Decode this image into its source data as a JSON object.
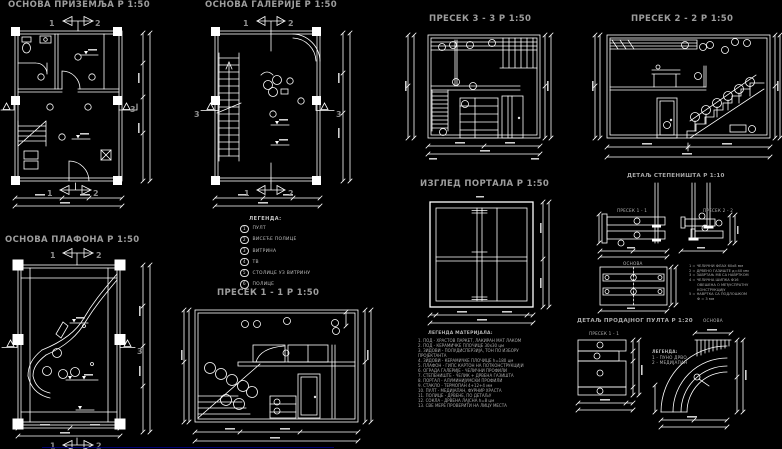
{
  "palette": {
    "background": "#000000",
    "lines": "#ffffff",
    "titles": "#9d9d9d",
    "markers": "#8f8f8f",
    "small_text": "#ababab",
    "underline_blue": "#00008b"
  },
  "markers": {
    "one": "1",
    "two": "2",
    "three": "3"
  },
  "drawings": {
    "ground_plan": {
      "title": "ОСНОВА ПРИЗЕМЉА  Р 1:50"
    },
    "gallery_plan": {
      "title": "ОСНОВА ГАЛЕРИЈЕ  Р 1:50"
    },
    "ceiling_plan": {
      "title": "ОСНОВА ПЛАФОНА   Р 1:50"
    },
    "section_1": {
      "title": "ПРЕСЕК 1 - 1 Р 1:50"
    },
    "section_3": {
      "title": "ПРЕСЕК 3 - 3 Р 1:50"
    },
    "section_2": {
      "title": "ПРЕСЕК 2 - 2  Р 1:50"
    },
    "portal": {
      "title": "ИЗГЛЕД ПОРТАЛА  Р 1:50"
    },
    "stair_detail": {
      "title": "ДЕТАЉ СТЕПЕНИШТА  Р 1:10",
      "sub_section_1": "ПРЕСЕК 1 - 1",
      "sub_section_2": "ПРЕСЕК 2 - 2",
      "sub_plan": "ОСНОВА",
      "legend_lines": [
        "1 = ЧЕЛИЧНИ ФЛАХ 60x8 мм",
        "2 = ДРВЕНО ГАЗИШТЕ д=40 мм",
        "3 = ЗАВРТАЊ М8 СА НАВРТКОМ",
        "4 = ЧЕЛИЧНА ШИПКА Ф16",
        "ОВЕШЕНА О МЕЂУСПРАТНУ",
        "КОНСТРУКЦИЈУ",
        "5 = НАВРТКА СА ПОДЛОШКОМ",
        "Ф = 3 мм"
      ]
    },
    "counter_detail": {
      "title": "ДЕТАЉ ПРОДАЈНОГ ПУЛТА  Р 1:20",
      "sub_section": "ПРЕСЕК 1 - 1",
      "sub_plan": "ОСНОВА",
      "legend_header": "ЛЕГЕНДА:",
      "legend_lines": [
        "1 - ПУНО ДРВО",
        "2 - МЕДИЈАПАН"
      ]
    }
  },
  "equipment_legend": {
    "header": "ЛЕГЕНДА:",
    "items": [
      {
        "num": "1",
        "label": "ПУЛТ"
      },
      {
        "num": "2",
        "label": "ВИСЕЋЕ ПОЛИЦЕ"
      },
      {
        "num": "3",
        "label": "ВИТРИНА"
      },
      {
        "num": "4",
        "label": "ТВ"
      },
      {
        "num": "5",
        "label": "СТОЛИЦЕ УЗ ВИТРИНУ"
      },
      {
        "num": "6",
        "label": "ПОЛИЦЕ"
      }
    ]
  },
  "materials_legend": {
    "header": "ЛЕГЕНДА МАТЕРИЈАЛА:",
    "lines": [
      "1. ПОД - ХРАСТОВ ПАРКЕТ, ЛАКИРАН МАТ ЛАКОМ",
      "2. ПОД - КЕРАМИЧКЕ ПЛОЧИЦЕ 30x30 цм",
      "3. ЗИДОВИ - ПОЛУДИСПЕРЗИЈА, ТОН ПО ИЗБОРУ",
      "    ПРОЈЕКТАНТА",
      "4. ЗИДОВИ - КЕРАМИЧКЕ ПЛОЧИЦЕ h=180 цм",
      "5. ПЛАФОН - ГИПС КАРТОН НА ПОТКОНСТРУКЦИЈИ",
      "6. ОГРАДА ГАЛЕРИЈЕ - ЧЕЛИЧНИ ПРОФИЛИ",
      "7. СТЕПЕНИШТЕ - ЧЕЛИК + ДРВЕНА ГАЗИШТА",
      "8. ПОРТАЛ - АЛУМИНИЈУМСКИ ПРОФИЛИ",
      "9. СТАКЛО - ТЕРМОПАН 4+12+4 мм",
      "10. ПУЛТ - МЕДИЈАПАН, ФУРНИР ХРАСТА",
      "11. ПОЛИЦЕ - ДРВЕНЕ, ПО ДЕТАЉУ",
      "12. СОКЛА - ДРВЕНА ЛАЈСНА h=8 цм",
      "13. СВЕ МЕРЕ ПРОВЕРИТИ НА ЛИЦУ МЕСТА"
    ]
  }
}
